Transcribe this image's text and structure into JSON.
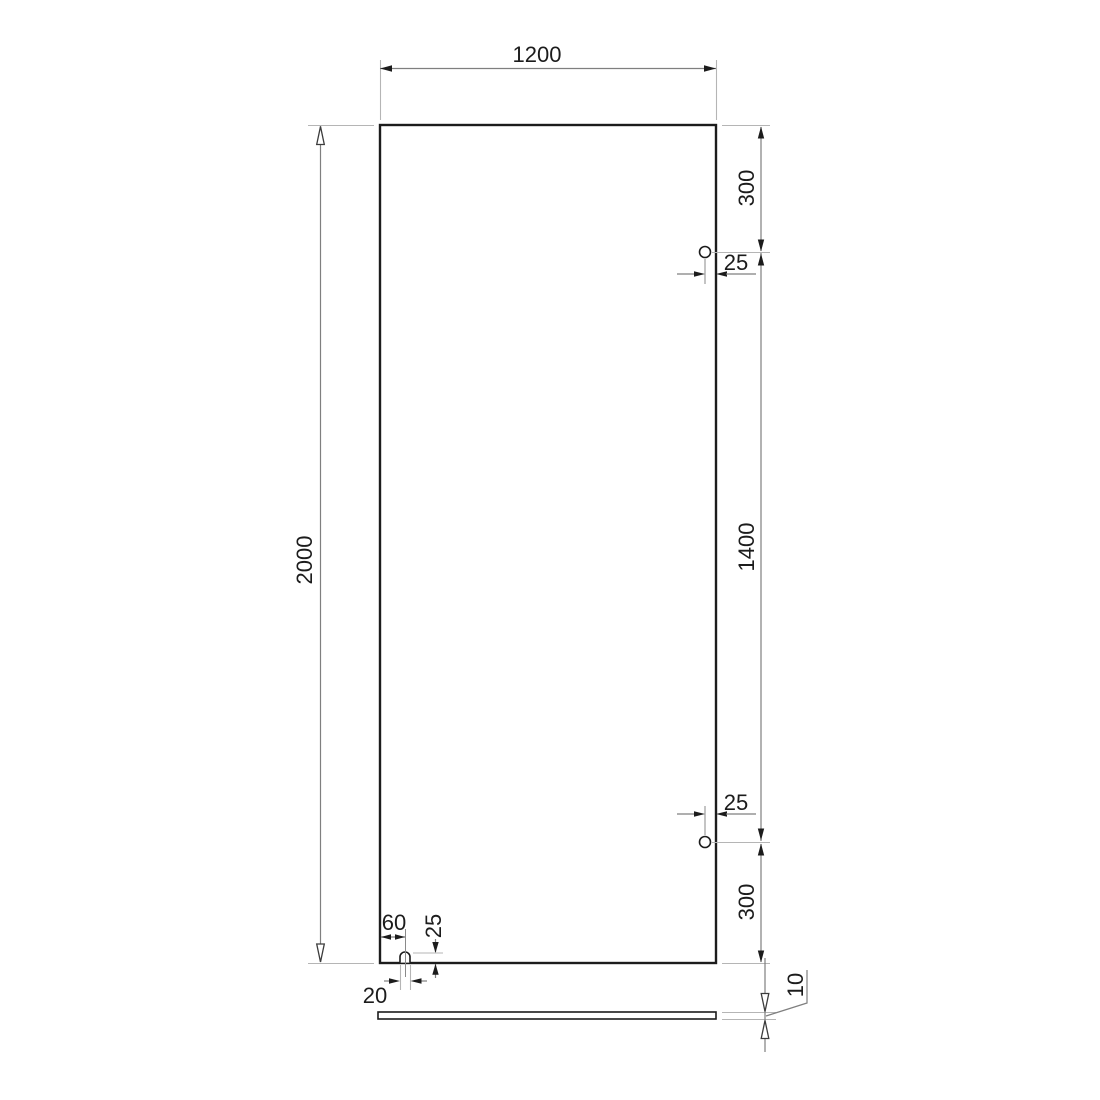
{
  "drawing": {
    "type": "technical-dimension-drawing",
    "views": {
      "front": "glass panel with two hinge holes and bottom slot",
      "bottom": "panel edge strip (thickness view)"
    },
    "labels": {
      "panel_width": "1200",
      "panel_height": "2000",
      "hole_top_offset": "300",
      "hole_top_edge_offset": "25",
      "hole_spacing": "1400",
      "hole_bottom_edge_offset": "25",
      "hole_bottom_offset": "300",
      "slot_center_from_left": "60",
      "slot_depth": "25",
      "slot_width": "20",
      "panel_thickness": "10"
    },
    "colors": {
      "background": "#ffffff",
      "object_outline": "#1c1c1c",
      "dimension_line": "#7f7f7f",
      "extension_line": "#b5b5b5",
      "text": "#1c1c1c"
    }
  }
}
